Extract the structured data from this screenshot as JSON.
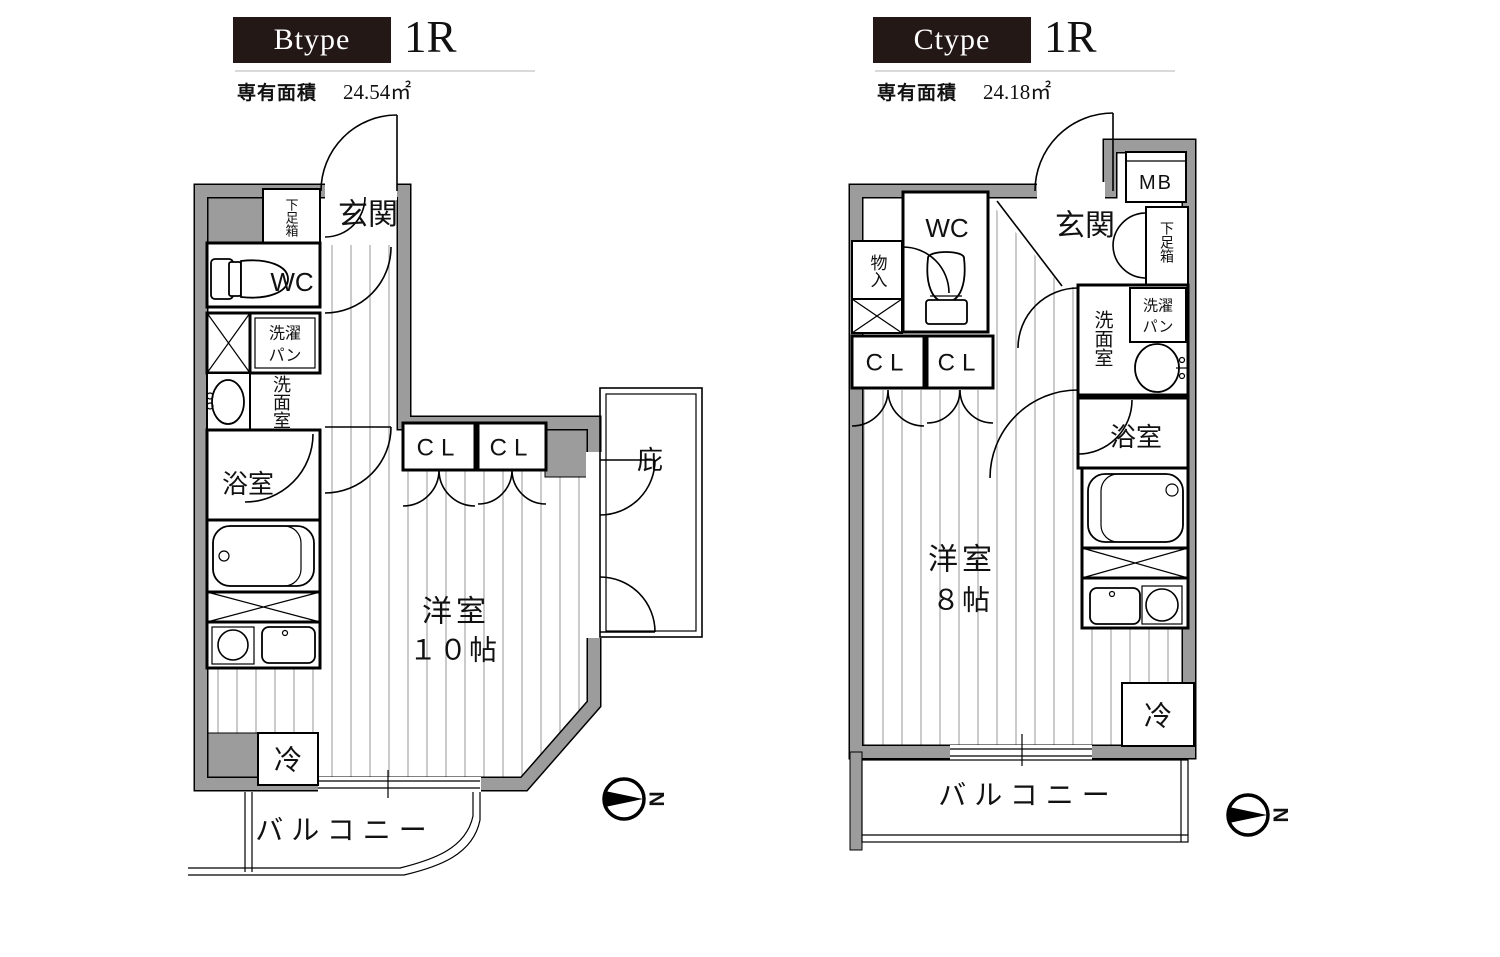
{
  "colors": {
    "wall": "#9c9c9c",
    "header_bg": "#231815",
    "rule": "#d9d9d9",
    "stripe": "#a9a9a9"
  },
  "plan_b": {
    "type": "Btype",
    "layout": "1R",
    "area_caption": "専有面積",
    "area_value": "24.54㎡",
    "genkan": "玄関",
    "shoe_box": "下足箱",
    "wc": "WC",
    "laundry1": "洗濯",
    "laundry2": "パン",
    "washroom": "洗面室",
    "bath": "浴室",
    "cl1": "CL",
    "cl2": "CL",
    "eaves": "庇",
    "room": "洋室",
    "room_size": "１０帖",
    "fridge": "冷",
    "balcony": "バルコニー",
    "north": "N"
  },
  "plan_c": {
    "type": "Ctype",
    "layout": "1R",
    "area_caption": "専有面積",
    "area_value": "24.18㎡",
    "mb": "MB",
    "wc": "WC",
    "genkan": "玄関",
    "shoe_box": "下足箱",
    "storage": "物入",
    "cl1": "CL",
    "cl2": "CL",
    "laundry1": "洗濯",
    "laundry2": "パン",
    "washroom": "洗面室",
    "bath": "浴室",
    "room": "洋室",
    "room_size": "８帖",
    "fridge": "冷",
    "balcony": "バルコニー",
    "north": "N"
  }
}
